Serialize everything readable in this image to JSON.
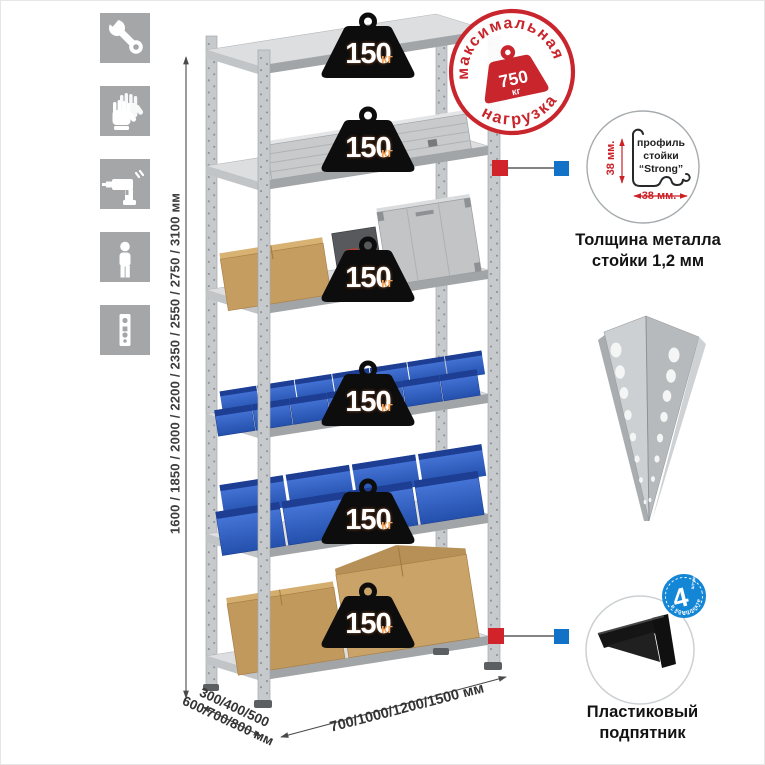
{
  "colors": {
    "accent_red": "#d1232a",
    "accent_blue": "#1272c8",
    "stamp_red": "#c9252c",
    "badge_blue": "#1486d6",
    "bin_blue": "#2f5fc4",
    "icon_bg": "#a4a6a8",
    "metal_gray": "#c7cacc"
  },
  "sidebar": {
    "icons": [
      {
        "name": "wrench"
      },
      {
        "name": "gloves"
      },
      {
        "name": "drill"
      },
      {
        "name": "person"
      },
      {
        "name": "upright-strip"
      }
    ]
  },
  "dimensions": {
    "height": "1600 / 1850 / 2000 / 2200 / 2350 / 2550 / 2750 / 3100 мм",
    "depth_line1": "300/400/500",
    "depth_line2": "600/700/800 мм",
    "width": "700/1000/1200/1500 мм"
  },
  "stamp": {
    "arc_top": "максимальная",
    "arc_bottom": "нагрузка",
    "weight_value": "750",
    "weight_unit": "кг"
  },
  "shelves": [
    {
      "load": "150",
      "unit": "кг"
    },
    {
      "load": "150",
      "unit": "кг"
    },
    {
      "load": "150",
      "unit": "кг"
    },
    {
      "load": "150",
      "unit": "кг"
    },
    {
      "load": "150",
      "unit": "кг"
    },
    {
      "load": "150",
      "unit": "кг"
    }
  ],
  "profile_callout": {
    "label_line1": "профиль",
    "label_line2": "стойки",
    "label_line3": "“Strong”",
    "dim_vertical": "38 мм.",
    "dim_horizontal": "38 мм.",
    "caption_line1": "Толщина металла",
    "caption_line2": "стойки 1,2 мм"
  },
  "foot_callout": {
    "badge_count": "4",
    "badge_small": "штуки",
    "badge_arc": "в комплекте",
    "caption_line1": "Пластиковый",
    "caption_line2": "подпятник"
  }
}
